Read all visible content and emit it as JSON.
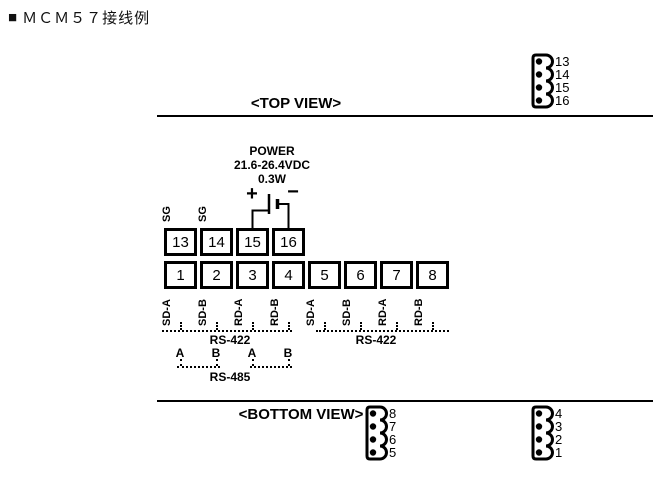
{
  "title": {
    "bullet": "■",
    "text": "ＭＣＭ５７接线例"
  },
  "views": {
    "top_label": "<TOP VIEW>",
    "bottom_label": "<BOTTOM VIEW>"
  },
  "power": {
    "line1": "POWER",
    "line2": "21.6-26.4VDC",
    "line3": "0.3W",
    "plus": "+",
    "minus": "−"
  },
  "terminals": {
    "top_row": [
      {
        "num": "13",
        "label": "SG"
      },
      {
        "num": "14",
        "label": "SG"
      },
      {
        "num": "15",
        "label": ""
      },
      {
        "num": "16",
        "label": ""
      }
    ],
    "bottom_row": [
      {
        "num": "1",
        "label": "SD-A"
      },
      {
        "num": "2",
        "label": "SD-B"
      },
      {
        "num": "3",
        "label": "RD-A"
      },
      {
        "num": "4",
        "label": "RD-B"
      },
      {
        "num": "5",
        "label": "SD-A"
      },
      {
        "num": "6",
        "label": "SD-B"
      },
      {
        "num": "7",
        "label": "RD-A"
      },
      {
        "num": "8",
        "label": "RD-B"
      }
    ]
  },
  "buses": {
    "rs422_left": "RS-422",
    "rs422_right": "RS-422",
    "rs485": "RS-485",
    "ab_labels": [
      "A",
      "B",
      "A",
      "B"
    ]
  },
  "connectors": {
    "top_right": {
      "pins": [
        "13",
        "14",
        "15",
        "16"
      ]
    },
    "bottom_left": {
      "pins": [
        "8",
        "7",
        "6",
        "5"
      ]
    },
    "bottom_right": {
      "pins": [
        "4",
        "3",
        "2",
        "1"
      ]
    }
  },
  "colors": {
    "line": "#000000",
    "bg": "#ffffff"
  }
}
